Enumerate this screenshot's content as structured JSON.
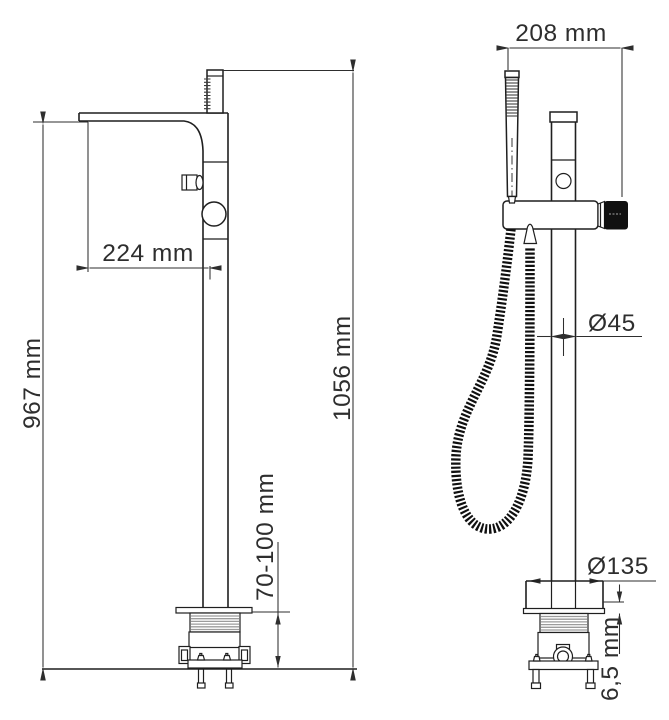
{
  "colors": {
    "background": "#ffffff",
    "line": "#1f1f1f",
    "dimension": "#2e2e2e",
    "handle_black": "#101010",
    "thread_hatch": "#9c9c9c"
  },
  "side_view": {
    "labels": {
      "spout_height": "967 mm",
      "overall_height": "1056 mm",
      "spout_reach": "224 mm",
      "floor_mount_depth": "70-100 mm"
    }
  },
  "front_view": {
    "labels": {
      "overall_width": "208 mm",
      "riser_diameter": "Ø45",
      "base_diameter": "Ø135",
      "base_plate_thickness": "6,5 mm"
    }
  }
}
